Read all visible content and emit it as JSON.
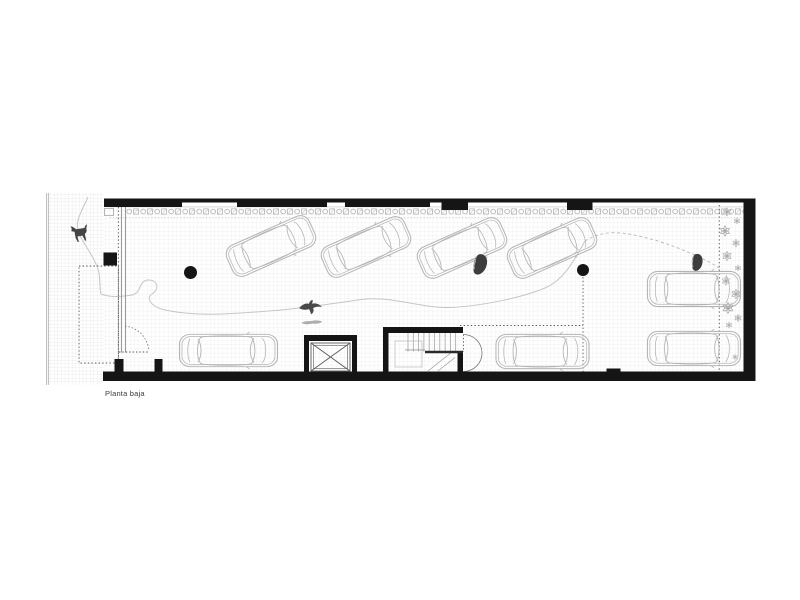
{
  "title_label": {
    "text": "Planta baja"
  },
  "plan": {
    "kind": "ground-floor parking garage plan",
    "colors": {
      "wall": "#151515",
      "car_outline": "#b4b4b4",
      "grid": "#e9e9ed",
      "figure_dark": "#3f3f3f",
      "shadow_gray": "#a0a0a0",
      "path_line": "#c6c6c6",
      "guide_dotted": "#555555",
      "band_motif": "#9c9c9c"
    }
  },
  "cars": [
    {
      "id": "car-1",
      "x": 271,
      "y": 246,
      "angle": -24,
      "length": 92,
      "width": 36
    },
    {
      "id": "car-2",
      "x": 366,
      "y": 247,
      "angle": -24,
      "length": 92,
      "width": 36
    },
    {
      "id": "car-3",
      "x": 462,
      "y": 248,
      "angle": -24,
      "length": 92,
      "width": 36
    },
    {
      "id": "car-4",
      "x": 552,
      "y": 248,
      "angle": -24,
      "length": 92,
      "width": 36
    },
    {
      "id": "car-5",
      "x": 228.5,
      "y": 350.5,
      "angle": 0,
      "length": 100,
      "width": 35
    },
    {
      "id": "car-6",
      "x": 542.5,
      "y": 351.5,
      "angle": 0,
      "length": 95,
      "width": 37
    },
    {
      "id": "car-7",
      "x": 694,
      "y": 289,
      "angle": 0,
      "length": 95,
      "width": 38
    },
    {
      "id": "car-8",
      "x": 694,
      "y": 348.5,
      "angle": 0,
      "length": 95,
      "width": 37
    }
  ],
  "columns": [
    {
      "x": 190.5,
      "y": 272.5,
      "r": 6.5
    },
    {
      "x": 583,
      "y": 270,
      "r": 6
    }
  ],
  "figures": [
    {
      "type": "dog",
      "x": 80,
      "y": 233,
      "scale": 1,
      "rotate": -10
    },
    {
      "type": "person",
      "x": 480,
      "y": 264,
      "scale": 1.1,
      "rotate": 8
    },
    {
      "type": "person",
      "x": 697,
      "y": 262,
      "scale": 0.9,
      "rotate": 0
    },
    {
      "type": "bird",
      "x": 312,
      "y": 306,
      "scale": 1,
      "rotate": 0
    },
    {
      "type": "bird-shadow",
      "x": 312,
      "y": 322,
      "scale": 1,
      "rotate": -4
    }
  ],
  "flowers": [
    {
      "x": 727,
      "y": 212,
      "s": 0.9
    },
    {
      "x": 737,
      "y": 221,
      "s": 0.7
    },
    {
      "x": 725,
      "y": 231,
      "s": 1.1
    },
    {
      "x": 736,
      "y": 243,
      "s": 0.8
    },
    {
      "x": 727,
      "y": 256,
      "s": 1.0
    },
    {
      "x": 738,
      "y": 268,
      "s": 0.7
    },
    {
      "x": 726,
      "y": 281,
      "s": 0.9
    },
    {
      "x": 736,
      "y": 294,
      "s": 1.0
    },
    {
      "x": 728,
      "y": 308,
      "s": 1.2
    },
    {
      "x": 738,
      "y": 318,
      "s": 0.8
    },
    {
      "x": 729,
      "y": 325,
      "s": 0.7
    },
    {
      "x": 735,
      "y": 357,
      "s": 0.6
    }
  ]
}
